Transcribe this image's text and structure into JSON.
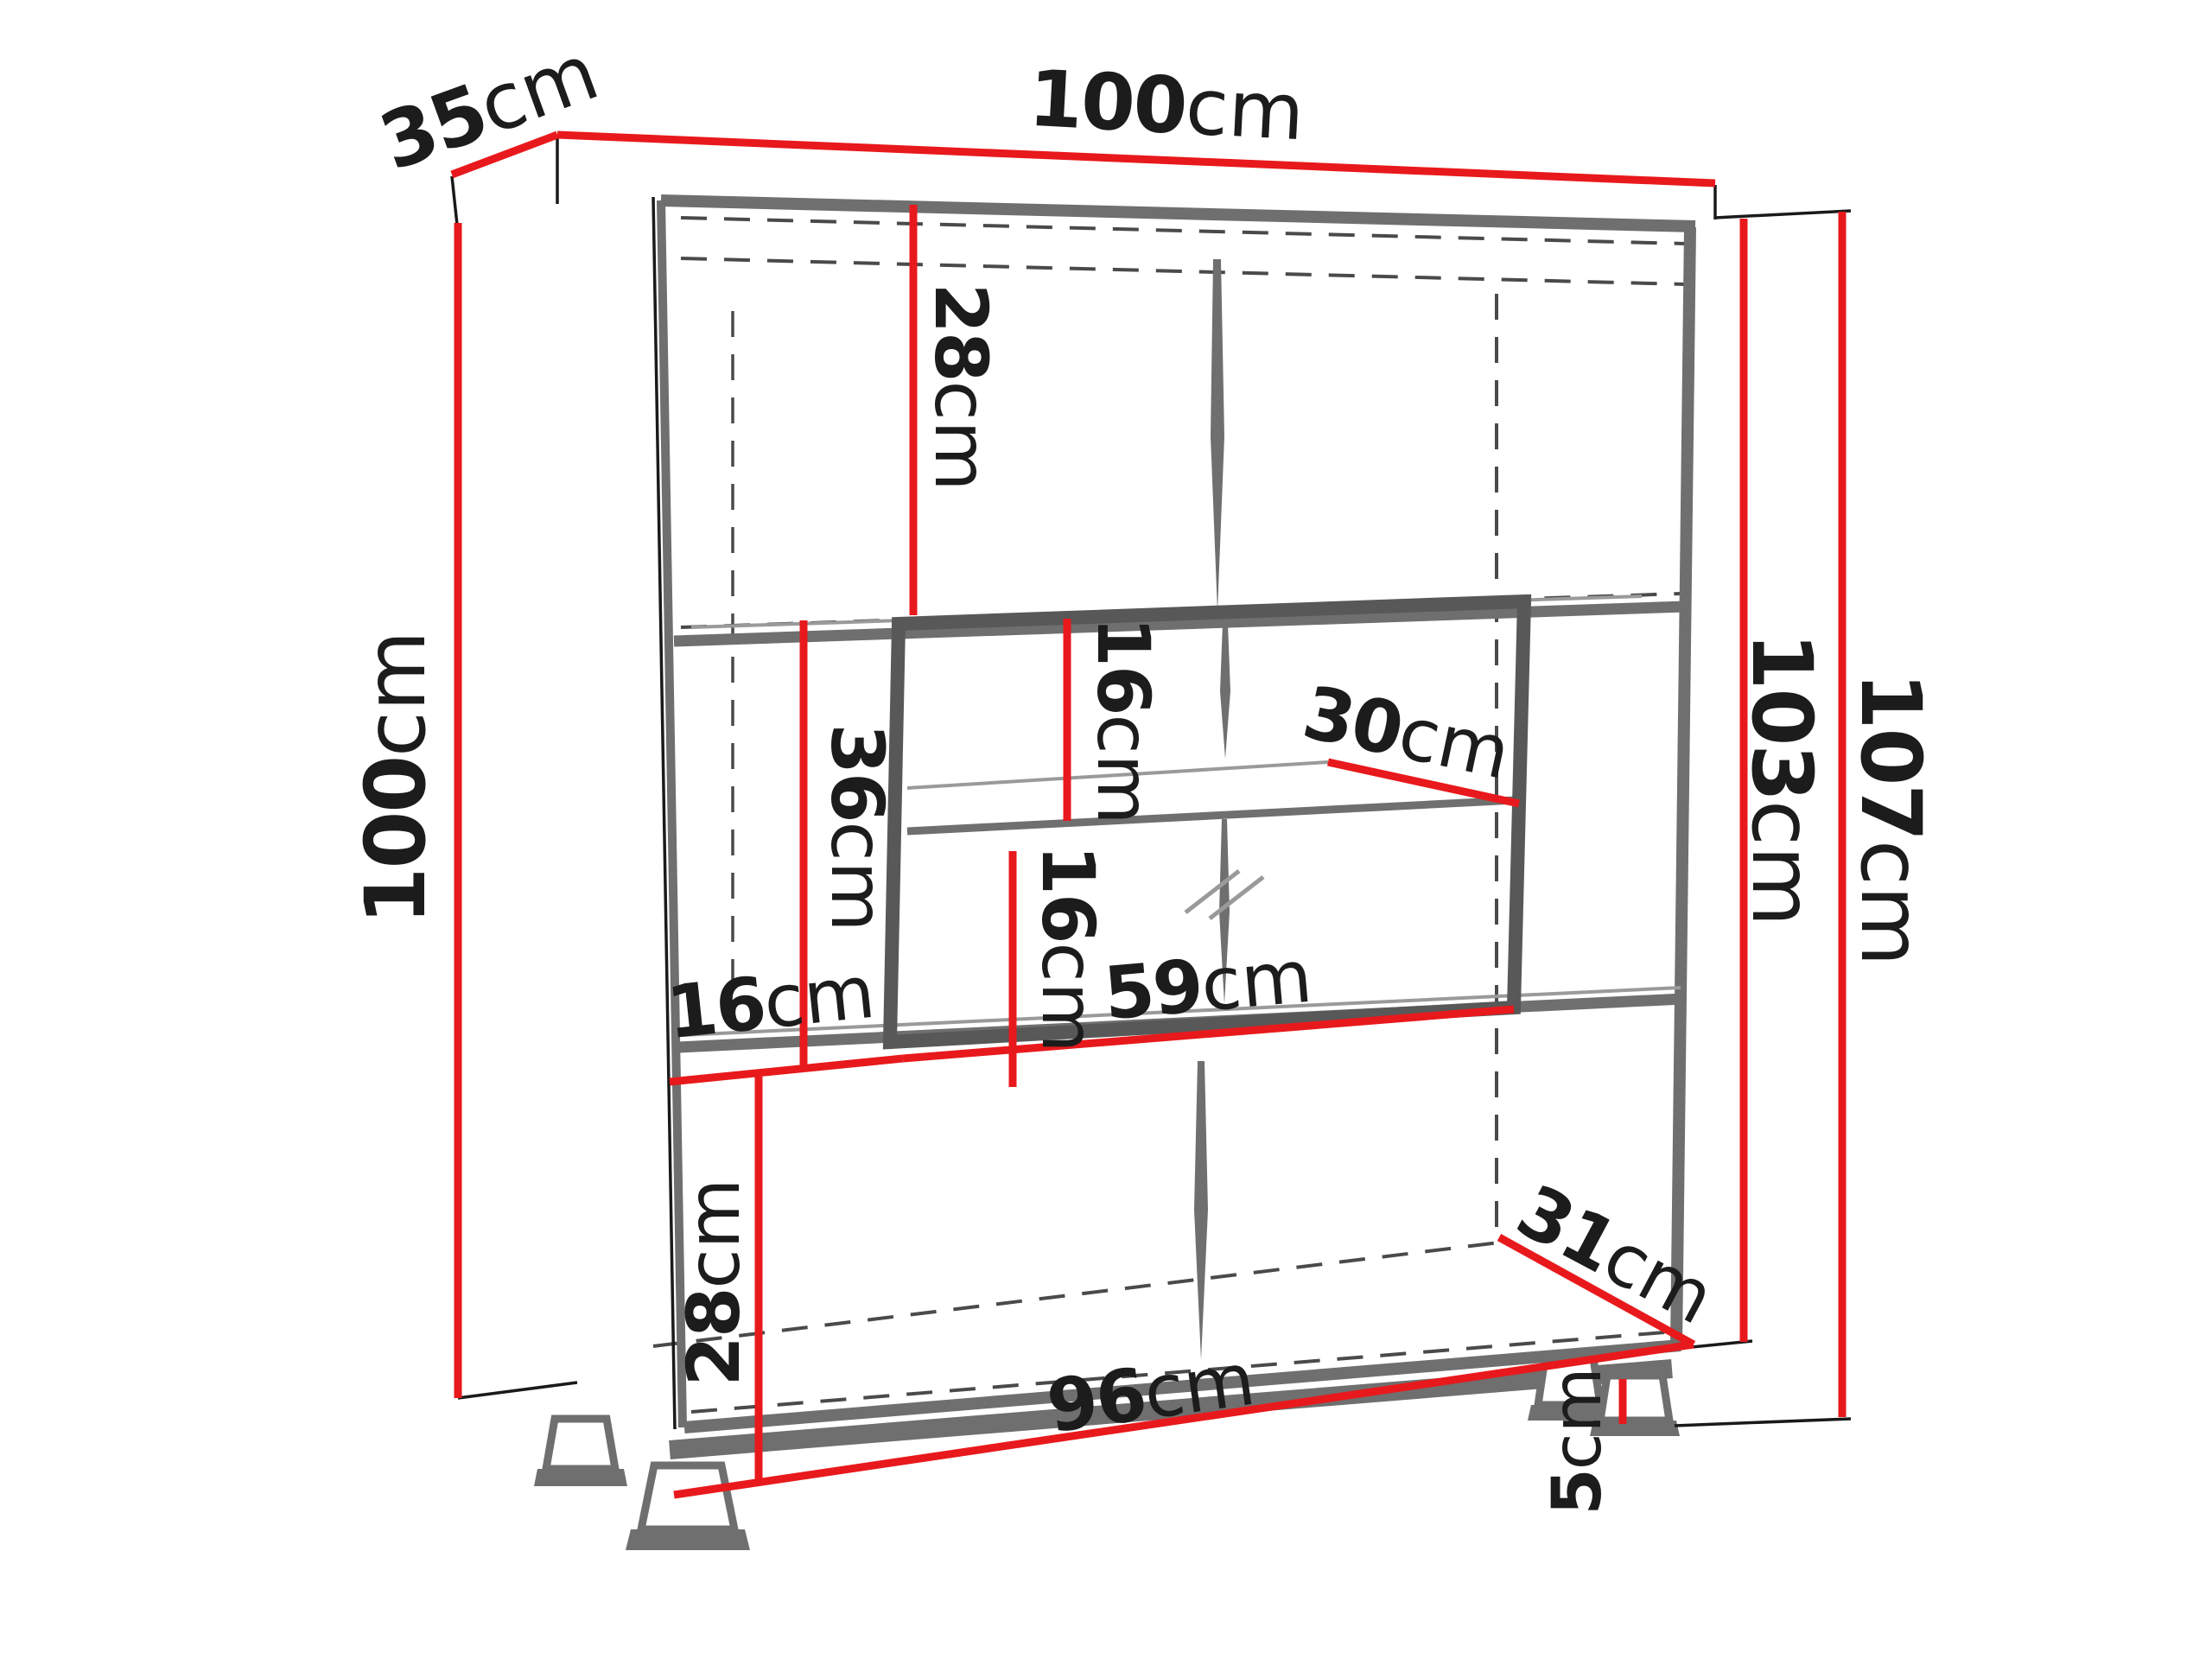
{
  "diagram": {
    "type": "furniture-dimension-diagram",
    "subject": "display cabinet with glass compartment, shelves and feet",
    "unit": "cm",
    "colors": {
      "dimension_accent": "#e8191c",
      "structure": "#6f6f6f",
      "hidden_edges": "#4a4a4a",
      "text": "#1c1c1c",
      "background": "#ffffff"
    },
    "dimensions": {
      "top_depth": {
        "value": "35",
        "unit": "cm"
      },
      "top_width": {
        "value": "100",
        "unit": "cm"
      },
      "left_height": {
        "value": "100",
        "unit": "cm"
      },
      "right_inner_height": {
        "value": "103",
        "unit": "cm"
      },
      "right_total_height": {
        "value": "107",
        "unit": "cm"
      },
      "top_section_height": {
        "value": "28",
        "unit": "cm"
      },
      "glass_top_gap": {
        "value": "16",
        "unit": "cm"
      },
      "shelf_depth": {
        "value": "30",
        "unit": "cm"
      },
      "middle_section_height": {
        "value": "36",
        "unit": "cm"
      },
      "glass_bottom_gap": {
        "value": "16",
        "unit": "cm"
      },
      "glass_width": {
        "value": "59",
        "unit": "cm"
      },
      "left_gap": {
        "value": "16",
        "unit": "cm"
      },
      "bottom_depth": {
        "value": "31",
        "unit": "cm"
      },
      "bottom_section_height": {
        "value": "28",
        "unit": "cm"
      },
      "bottom_width": {
        "value": "96",
        "unit": "cm"
      },
      "foot_height": {
        "value": "5",
        "unit": "cm"
      }
    }
  }
}
